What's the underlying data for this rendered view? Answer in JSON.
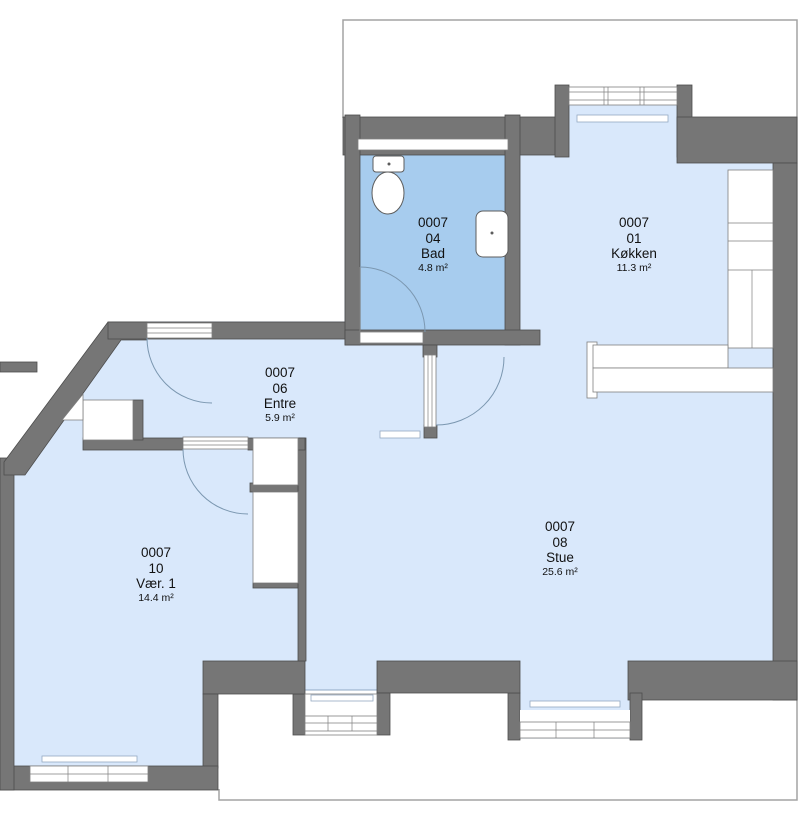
{
  "plan": {
    "unit_id": "0007",
    "colors": {
      "wall": "#767676",
      "room_fill": "#d9e8fb",
      "highlight_fill": "#a7ccee",
      "roof_outline": "#a3a3a3",
      "text": "#111111"
    }
  },
  "rooms": [
    {
      "id": "0007",
      "number": "04",
      "name": "Bad",
      "area": "4.8 m²",
      "highlighted": true
    },
    {
      "id": "0007",
      "number": "01",
      "name": "Køkken",
      "area": "11.3 m²",
      "highlighted": false
    },
    {
      "id": "0007",
      "number": "06",
      "name": "Entre",
      "area": "5.9 m²",
      "highlighted": false
    },
    {
      "id": "0007",
      "number": "10",
      "name": "Vær. 1",
      "area": "14.4 m²",
      "highlighted": false
    },
    {
      "id": "0007",
      "number": "08",
      "name": "Stue",
      "area": "25.6 m²",
      "highlighted": false
    }
  ],
  "fixtures": [
    "toilet",
    "sink",
    "kitchen-counter",
    "radiator",
    "duct-shaft"
  ]
}
